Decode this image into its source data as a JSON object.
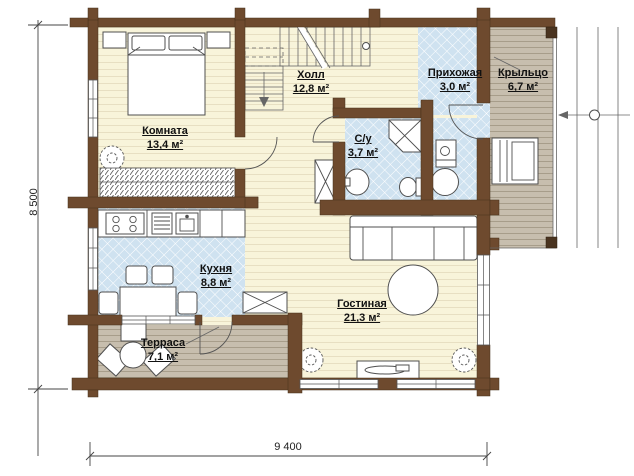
{
  "title": "Floor plan of a timber house, first floor",
  "rooms": [
    {
      "name": "Комната",
      "area": "13,4 м²"
    },
    {
      "name": "Холл",
      "area": "12,8 м²"
    },
    {
      "name": "Прихожая",
      "area": "3,0 м²"
    },
    {
      "name": "Крыльцо",
      "area": "6,7 м²"
    },
    {
      "name": "С/у",
      "area": "3,7 м²"
    },
    {
      "name": "Кухня",
      "area": "8,8 м²"
    },
    {
      "name": "Гостиная",
      "area": "21,3 м²"
    },
    {
      "name": "Терраса",
      "area": "7,1 м²"
    }
  ],
  "dimensions": {
    "height": "8 500",
    "width": "9 400"
  },
  "colors": {
    "wall": "#6e4a2e",
    "floor_wood": "#f8f4da",
    "floor_line": "#e7dfc2",
    "tile": "#cfe2f0",
    "tile_line": "#ffffff",
    "deck": "#c7beae",
    "deck_line": "#a79d8a"
  }
}
